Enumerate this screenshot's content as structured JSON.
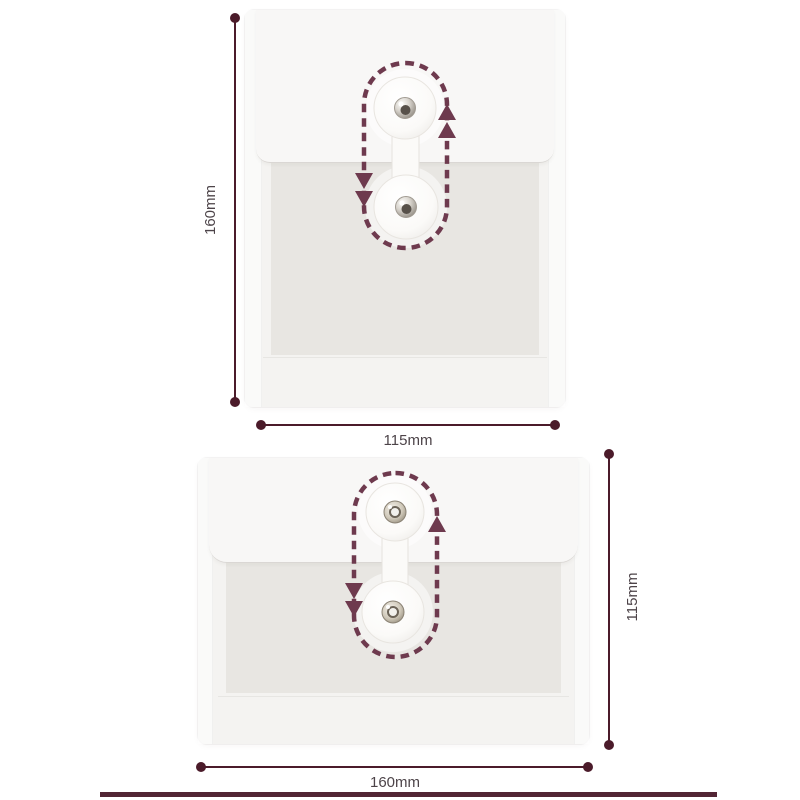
{
  "figure": {
    "background": "#ffffff",
    "dimension_color": "#4b1b2a",
    "string_path_color": "#6e3a4e",
    "label_color": "#4d4449",
    "footer_rule_color": "#522534",
    "envelopes": [
      {
        "name": "portrait button-and-string envelope",
        "orientation": "portrait",
        "height_label": "160mm",
        "width_label": "115mm",
        "fastener_icon": "snap-button-icon",
        "string_path_icon": "dashed-string-loop-icon",
        "arrow_icons": [
          "arrow-up-icon",
          "arrow-down-icon"
        ]
      },
      {
        "name": "landscape button-and-string envelope",
        "orientation": "landscape",
        "height_label": "115mm",
        "width_label": "160mm",
        "fastener_icon": "eyelet-button-icon",
        "string_path_icon": "dashed-string-loop-icon",
        "arrow_icons": [
          "arrow-up-icon",
          "arrow-down-icon"
        ]
      }
    ]
  }
}
